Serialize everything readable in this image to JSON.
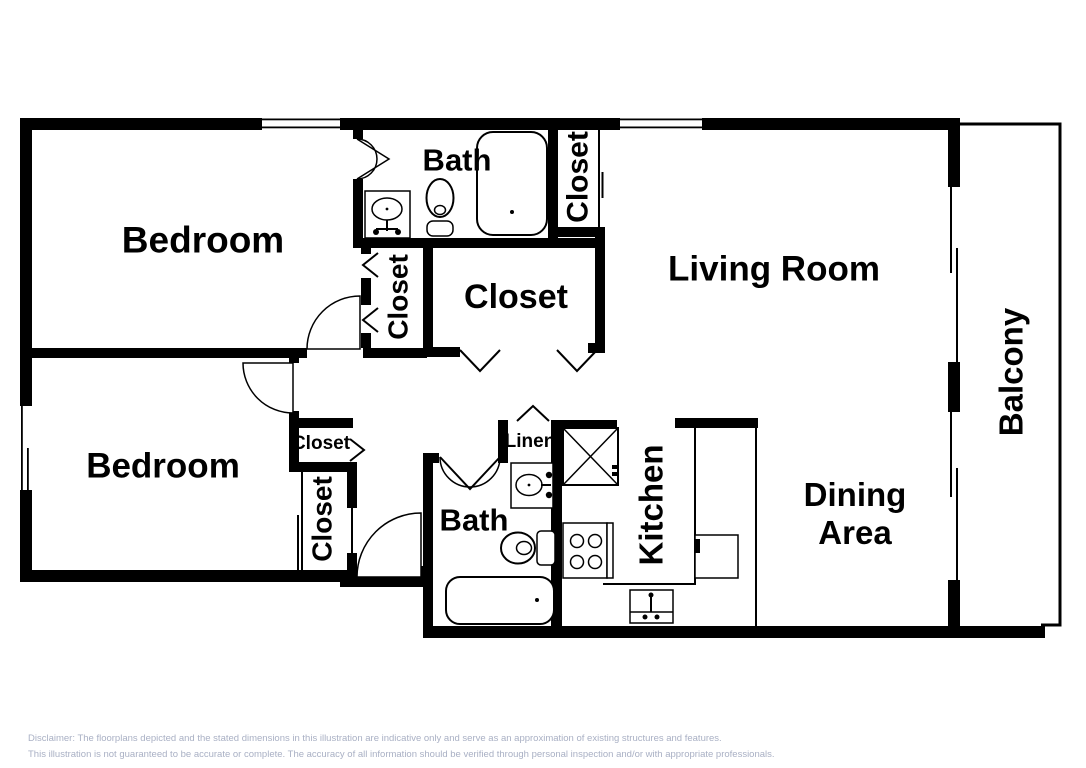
{
  "colors": {
    "wall": "#000000",
    "background": "#ffffff",
    "label_text": "#000000",
    "disclaimer_text": "#a9b0c4"
  },
  "floorplan": {
    "rooms": {
      "bedroom_top": "Bedroom",
      "bath_top": "Bath",
      "closet_bath_top": "Closet",
      "living_room": "Living Room",
      "closet_bedroom_top": "Closet",
      "closet_center": "Closet",
      "bedroom_bottom": "Bedroom",
      "closet_small": "Closet",
      "closet_bedroom_bottom": "Closet",
      "linen": "Linen",
      "bath_bottom": "Bath",
      "kitchen": "Kitchen",
      "dining_area": "Dining Area",
      "balcony": "Balcony"
    },
    "icons": {
      "bathtub": "bathtub-icon",
      "toilet": "toilet-icon",
      "sink": "sink-icon",
      "refrigerator": "refrigerator-icon",
      "stove": "stove-icon",
      "kitchen_sink": "kitchen-sink-icon",
      "door_swing": "door-swing-icon",
      "window": "window-icon"
    }
  },
  "disclaimer": {
    "line1": "Disclaimer: The floorplans depicted and the stated dimensions in this illustration are indicative only and serve as an approximation of existing structures and features.",
    "line2": "This illustration is not guaranteed to be accurate or complete. The accuracy of all information should be verified through personal inspection and/or with appropriate professionals."
  }
}
